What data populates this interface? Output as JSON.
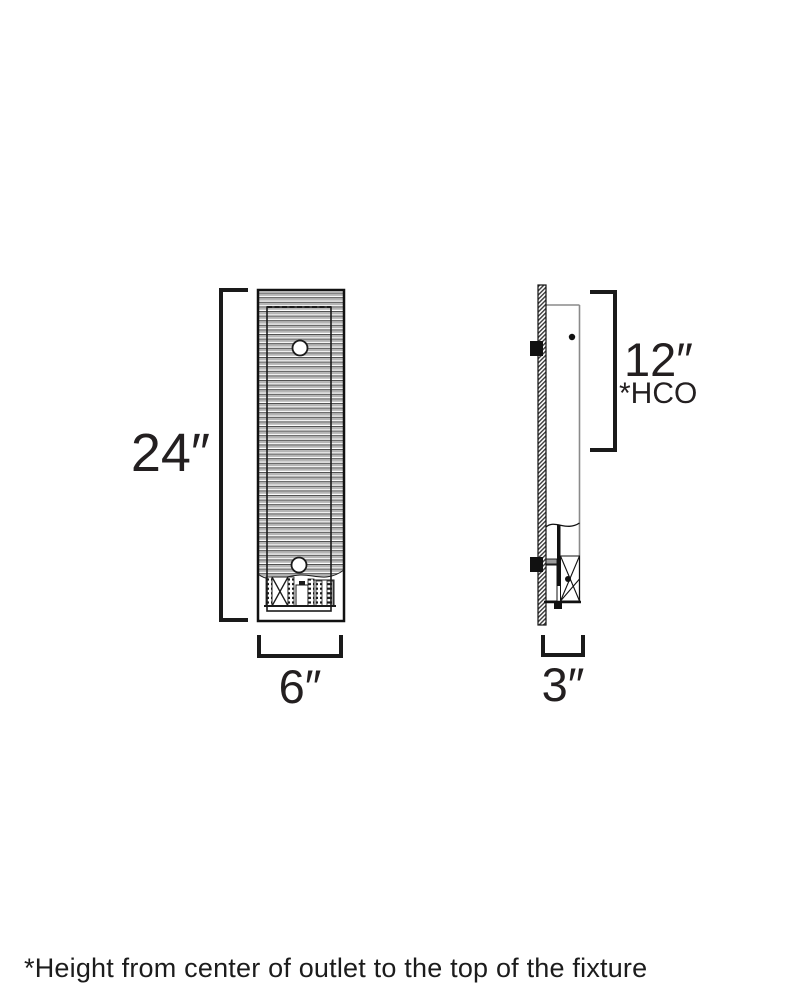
{
  "diagram": {
    "front_view": {
      "height_label": "24″",
      "width_label": "6″"
    },
    "side_view": {
      "depth_label": "3″",
      "hco_value": "12″",
      "hco_label": "*HCO"
    },
    "footnote": "*Height from center of outlet to the top of the fixture"
  },
  "colors": {
    "line": "#231f20",
    "stripe_gray": "#b5b5b5",
    "profile_gray": "#8a8a8a",
    "background": "#ffffff"
  }
}
